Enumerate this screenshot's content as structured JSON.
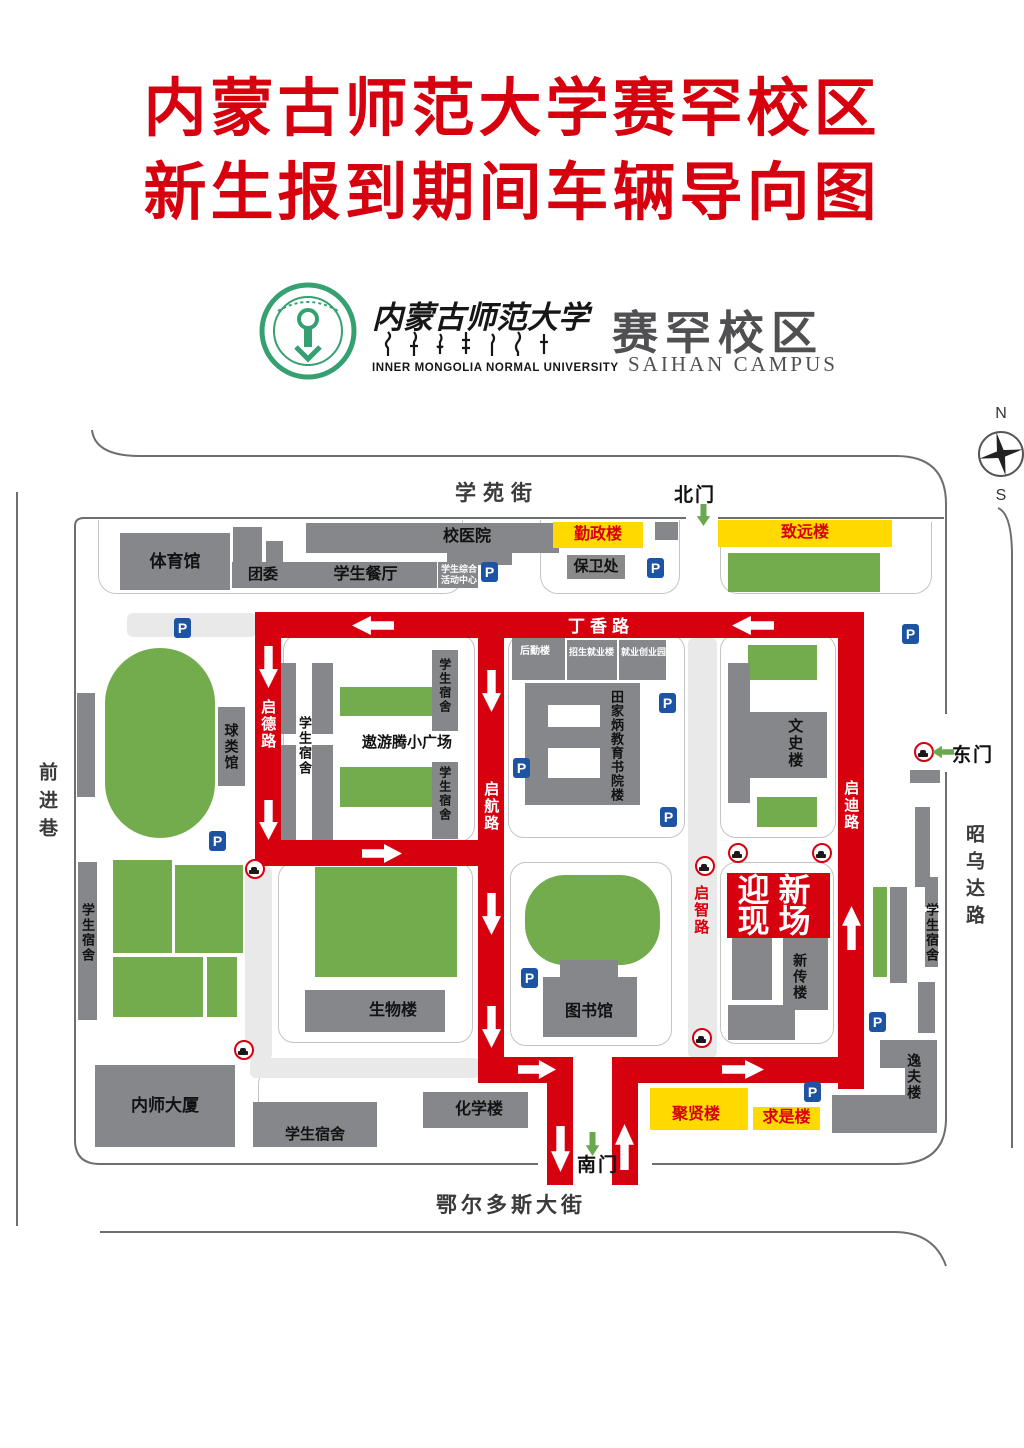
{
  "title": {
    "line1": "内蒙古师范大学赛罕校区",
    "line2": "新生报到期间车辆导向图"
  },
  "logo": {
    "university_cn": "内蒙古师范大学",
    "university_en": "INNER MONGOLIA NORMAL UNIVERSITY",
    "campus_cn": "赛罕校区",
    "campus_en": "SAIHAN CAMPUS"
  },
  "compass": {
    "north": "N",
    "south": "S"
  },
  "streets": {
    "north": "学苑街",
    "south": "鄂尔多斯大街",
    "west": "前进巷",
    "east": "昭乌达路"
  },
  "gates": {
    "north": "北门",
    "south": "南门",
    "east": "东门"
  },
  "roads": {
    "dingxiang": "丁香路",
    "qide": "启德路",
    "qihang": "启航路",
    "qidi": "启迪路",
    "qizhi": "启智路"
  },
  "welcome": {
    "line1": "迎新",
    "line2": "现场"
  },
  "icons": {
    "parking": "P"
  },
  "buildings": {
    "tiyuguan": "体育馆",
    "tuanwei": "团委",
    "canting": "学生餐厅",
    "xiaoyiyuan": "校医院",
    "zonghe_line1": "学生综合",
    "zonghe_line2": "活动中心",
    "qinzheng": "勤政楼",
    "baowei": "保卫处",
    "zhiyuan": "致远楼",
    "qiuleiguan": "球类馆",
    "sushe": "学生宿舍",
    "aoyouteng": "遨游腾小广场",
    "houqin": "后勤楼",
    "zhaojiu": "招生就业楼",
    "jiuchuang": "就业创业园",
    "tianjiabing": "田家炳教育书院楼",
    "wenshi": "文史楼",
    "xinchuan": "新传楼",
    "shengwu": "生物楼",
    "tushuguan": "图书馆",
    "neishi": "内师大厦",
    "huaxue": "化学楼",
    "juxian": "聚贤楼",
    "qiushi": "求是楼",
    "yifu": "逸夫楼"
  },
  "colors": {
    "accent_red": "#d7000f",
    "building_gray": "#85878a",
    "lawn_green": "#72ac4d",
    "highlight_yellow": "#ffd900",
    "parking_blue": "#1c53a3",
    "gate_green": "#6aa84f"
  }
}
